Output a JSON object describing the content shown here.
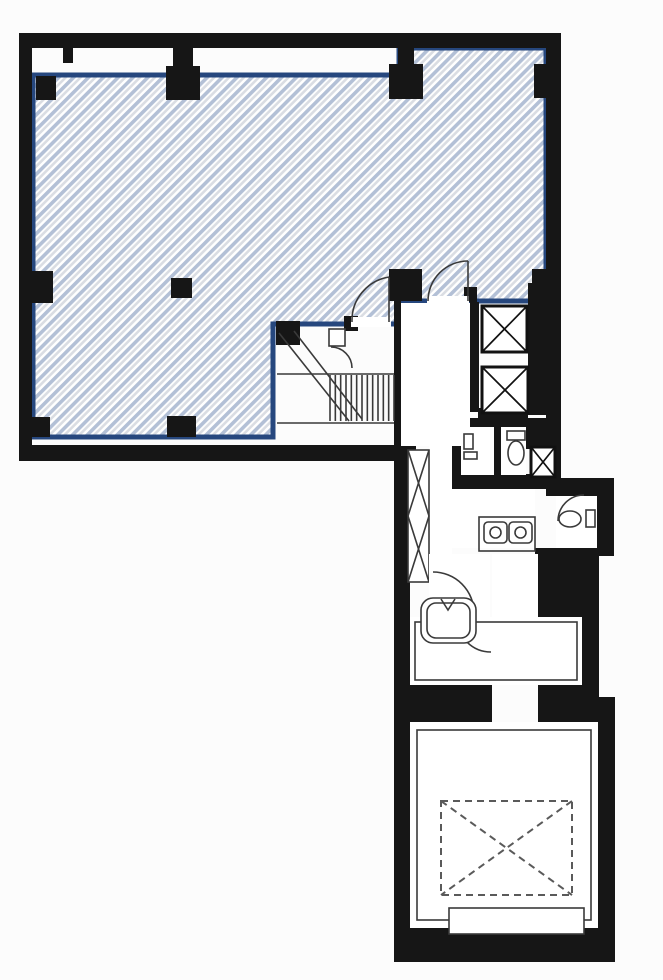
{
  "colors": {
    "wall": "#161616",
    "outline_blue": "#26477e",
    "hatch_stripe_blue": "#b3c0d6",
    "hatch_stripe_gray": "#dadde3",
    "hatch_background": "#ffffff",
    "room_fill": "#ffffff",
    "line": "#3a3a3a",
    "dashed_line": "#5a5a5a",
    "paper": "#fcfcfc"
  },
  "plan": {
    "leased_area": {
      "hatch_direction": "diagonal-rising",
      "outline": "blue"
    },
    "stairs": {
      "tread_count": 13
    },
    "elevators": {
      "count": 2,
      "symbol": "box-with-x"
    },
    "pipe_shaft": {
      "symbol": "tall-box-with-x"
    },
    "small_shaft": {
      "symbol": "box-with-x"
    },
    "restroom": {
      "toilets": 2,
      "sinks": 2
    },
    "machine_hatch": {
      "symbol": "dashed-box-with-x"
    }
  }
}
